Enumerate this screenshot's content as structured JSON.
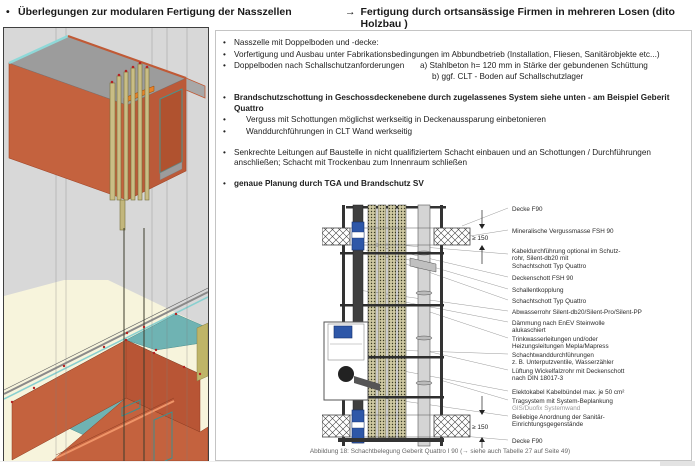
{
  "header": {
    "marker": "•",
    "title": "Überlegungen zur modularen Fertigung der Nasszellen",
    "arrow": "→",
    "subtitle": "Fertigung durch ortsansässige Firmen in mehreren Losen (dito Holzbau )"
  },
  "bullets": {
    "marker": "•",
    "b1": "Nasszelle mit Doppelboden und -decke:",
    "b2": "Vorfertigung und Ausbau unter Fabrikationsbedingungen im Abbundbetrieb (Installation, Fliesen, Sanitärobjekte etc...)",
    "b3": "Doppelboden nach Schallschutzanforderungen",
    "b3a": "a) Stahlbeton h= 120 mm in Stärke der gebundenen Schüttung",
    "b3b": "b) ggf. CLT - Boden auf Schallschutzlager",
    "b4": "Brandschutzschottung in Geschossdeckenebene durch zugelassenes System siehe unten - am Beispiel Geberit Quattro",
    "b4a": "Verguss mit Schottungen möglichst werkseitig in Deckenaussparung einbetonieren",
    "b4b": "Wanddurchführungen in CLT Wand werkseitig",
    "b5": "Senkrechte Leitungen auf Baustelle in nicht qualifiziertem Schacht einbauen und an Schottungen / Durchführungen\nanschließen;  Schacht mit Trockenbau zum Innenraum schließen",
    "b6": "genaue Planung durch TGA und Brandschutz SV"
  },
  "diagram": {
    "dim_top": "≥ 150",
    "dim_bottom": "≥ 150",
    "labels": [
      {
        "text": "Decke F90"
      },
      {
        "text": "Mineralische Vergussmasse FSH 90"
      },
      {
        "text": "Kabeldurchführung optional im Schutz-\nrohr, Silent-db20 mit\nSchachtschott Typ Quattro"
      },
      {
        "text": "Deckenschott FSH 90"
      },
      {
        "text": "Schallentkopplung"
      },
      {
        "text": "Schachtschott Typ Quattro"
      },
      {
        "text": "Abwasserrohr Silent-db20/Silent-Pro/Silent-PP"
      },
      {
        "text": "Dämmung nach EnEV Steinwolle\nalukaschiert"
      },
      {
        "text": "Trinkwasserleitungen und/oder\nHeizungsleitungen Mepla/Mapress"
      },
      {
        "text": "Schachtwanddurchführungen\nz. B. Unterputzventile, Wasserzähler"
      },
      {
        "text": "Lüftung Wickelfalzrohr mit Deckenschott\nnach DIN 18017-3"
      },
      {
        "text": "Elektokabel Kabelbündel max. je 50 cm²"
      },
      {
        "text": "Tragsystem mit System-Beplankung",
        "sub": "GIS/Duofix Systemwand"
      },
      {
        "text": "Beliebige Anordnung der Sanitär-\nEinrichtungsgegenstände"
      },
      {
        "text": "Decke F90"
      }
    ],
    "caption": "Abbildung 18: Schachtbelegung Geberit Quattro I 90 (→ siehe auch Tabelle 27 auf Seite 49)"
  },
  "colors": {
    "wall_orange": "#c4623e",
    "floor_teal": "#6fb3b3",
    "pipe_tan": "#c9bd85",
    "pipe_blue": "#2e57a8",
    "background_gray": "#d8d8d8",
    "background_cream": "#f7f4dc"
  }
}
